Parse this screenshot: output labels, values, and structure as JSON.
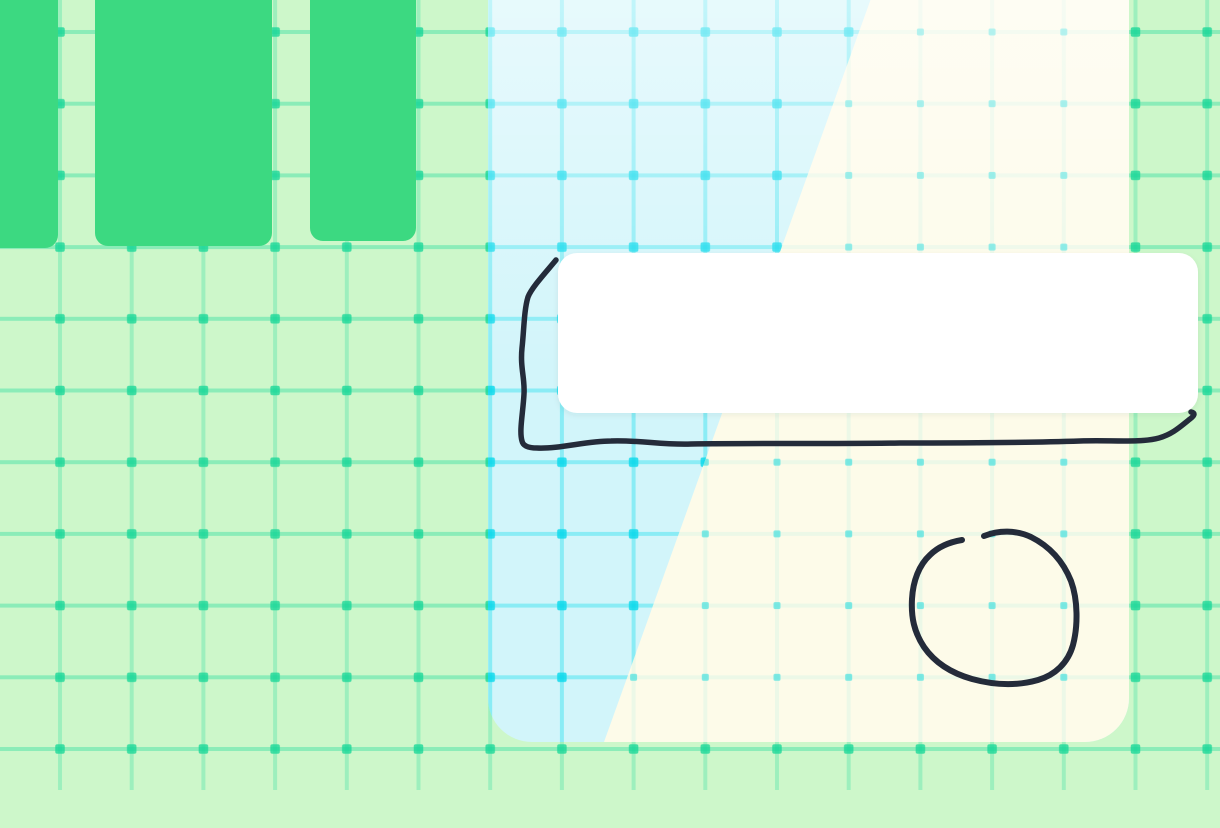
{
  "scene": {
    "type": "whiteboard-canvas",
    "description": "Light green grid canvas with three solid green blocks at the top left, a large rounded two-tone panel (cyan on the left diagonally fading to cream on the right), a blank white note card, and two freehand dark ink strokes: an open frame drawn around the note card and a loop drawn in the cream area."
  },
  "grid": {
    "spacing_px": 71.7,
    "line_width_px": 4,
    "vertical_origin_x": 60,
    "horizontal_origin_y": 32
  },
  "colors": {
    "background_green": "#cdf7ca",
    "grid_line_green_v": "rgba(47,222,160,0.30)",
    "grid_line_green_h": "rgba(47,222,160,0.42)",
    "grid_dot_green": "rgba(18,214,150,0.75)",
    "block_green": "#3cd981",
    "panel_cyan": "#d2f5fa",
    "panel_cream": "#fdfbe9",
    "grid_line_cyan": "rgba(30,222,238,0.40)",
    "grid_dot_cyan": "rgba(6,216,235,0.80)",
    "grid_line_cream": "rgba(140,230,220,0.15)",
    "grid_dot_cream": "rgba(48,222,222,0.60)",
    "panel_top_fade": "#ffffff",
    "card_white": "#ffffff",
    "ink": "#242b3a"
  },
  "ink": {
    "card_outline_path": "M 556 260 C 547 271 532 287 528 297 C 524 310 524 330 522 348 C 520 368 525 378 524 394 C 523 413 519 431 522 441 C 523 446 529 448 537 448 C 560 449 586 441 611 441 C 641 440 661 445 691 444 C 760 443 830 444 900 443 C 960 443 1020 443 1080 441 C 1112 440 1141 443 1159 438 C 1173 434 1181 426 1190 419 C 1194 416 1196 413 1191 412",
    "circle_path": "M 984 536 C 999 530 1016 530 1031 537 C 1049 546 1063 561 1071 581 C 1078 600 1078 626 1073 645 C 1068 663 1055 675 1038 680 C 1017 686 994 685 972 679 C 951 673 935 663 924 647 C 914 632 911 617 912 599 C 913 581 919 565 930 555 C 939 546 950 542 962 540"
  }
}
